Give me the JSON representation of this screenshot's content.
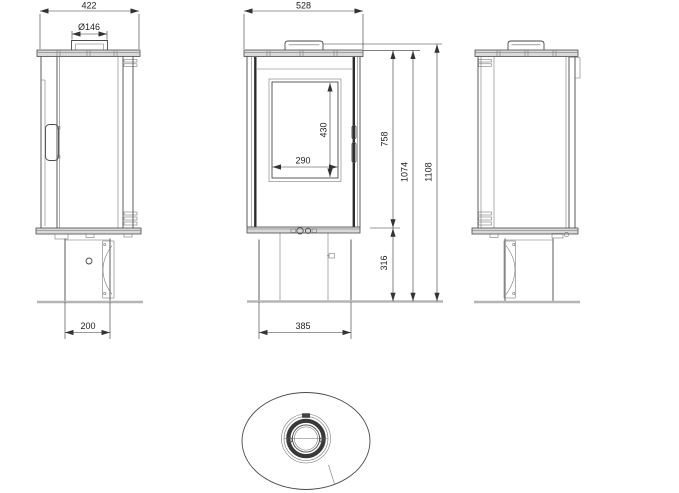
{
  "drawing": {
    "type": "stove-technical-drawing",
    "views": [
      "side-left",
      "front",
      "side-right",
      "top"
    ],
    "dims": {
      "depth": "422",
      "flue_diameter": "Ø146",
      "base_depth": "200",
      "width": "528",
      "glass_width": "290",
      "glass_height": "430",
      "body_height": "758",
      "height_to_top": "1074",
      "total_height": "1108",
      "base_height": "316",
      "base_width": "385"
    },
    "colors": {
      "line": "#4a4a4a",
      "dimension": "#333333",
      "plate_fill": "#d9d9d9",
      "floor_line": "#b5b5b5",
      "background": "#ffffff"
    }
  }
}
